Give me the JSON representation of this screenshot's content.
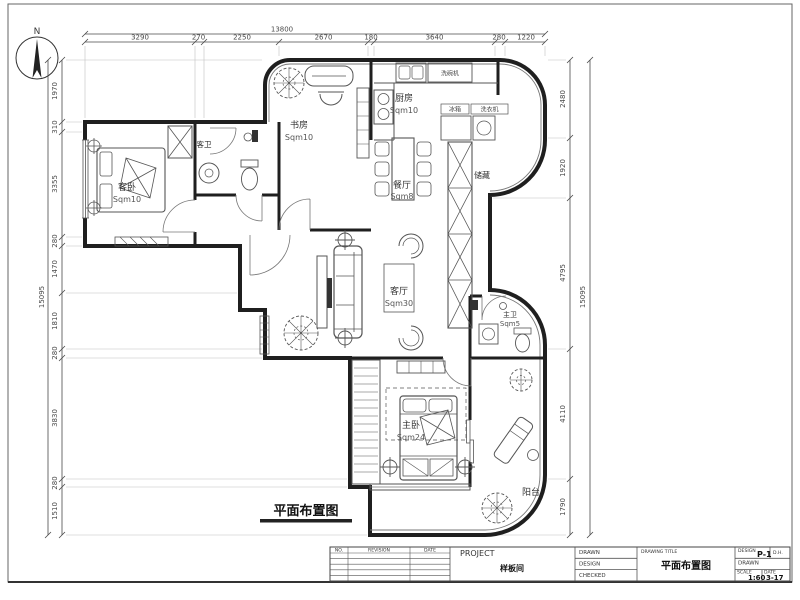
{
  "compass": {
    "label": "N"
  },
  "dims": {
    "top": {
      "total": "13800",
      "segs": [
        "3290",
        "270",
        "2250",
        "2670",
        "180",
        "3640",
        "280",
        "1220"
      ]
    },
    "left": {
      "total": "15095",
      "segs": [
        "1970",
        "310",
        "3355",
        "280",
        "1470",
        "1810",
        "280",
        "3830",
        "280",
        "1510"
      ]
    },
    "right": {
      "total": "15095",
      "segs": [
        "2480",
        "1920",
        "4795",
        "4110",
        "1790"
      ]
    }
  },
  "rooms": {
    "guest_bedroom": {
      "name": "客卧",
      "area": "Sqm10"
    },
    "guest_bath": {
      "name": "客卫"
    },
    "study": {
      "name": "书房",
      "area": "Sqm10"
    },
    "kitchen": {
      "name": "厨房",
      "area": "Sqm10"
    },
    "dining": {
      "name": "餐厅",
      "area": "Sqm8"
    },
    "storage": {
      "name": "储藏"
    },
    "living": {
      "name": "客厅",
      "area": "Sqm30"
    },
    "master_bedroom": {
      "name": "主卧",
      "area": "Sqm24"
    },
    "master_bath": {
      "name": "主卫",
      "area": "Sqm5"
    },
    "balcony": {
      "name": "阳台"
    }
  },
  "labels": {
    "fridge": "冰箱",
    "washer": "洗衣机",
    "dishwasher": "洗碗机"
  },
  "plan_title": "平面布置图",
  "titleblock": {
    "rev_no": "NO.",
    "rev_desc": "REVISION",
    "rev_date": "DATE",
    "project_label": "PROJECT",
    "project_name": "样板间",
    "drawn": "DRAWN",
    "design": "DESIGN",
    "checked": "CHECKED",
    "drawing_title_label": "DRAWING TITLE",
    "drawing_title": "平面布置图",
    "design2": "DESIGN",
    "drawing_no": "P-1",
    "designer": "D.H.",
    "drawn2": "DRAWN",
    "scale_label": "SCALE",
    "scale": "1:60",
    "date_label": "DATE",
    "date": "3-17"
  }
}
